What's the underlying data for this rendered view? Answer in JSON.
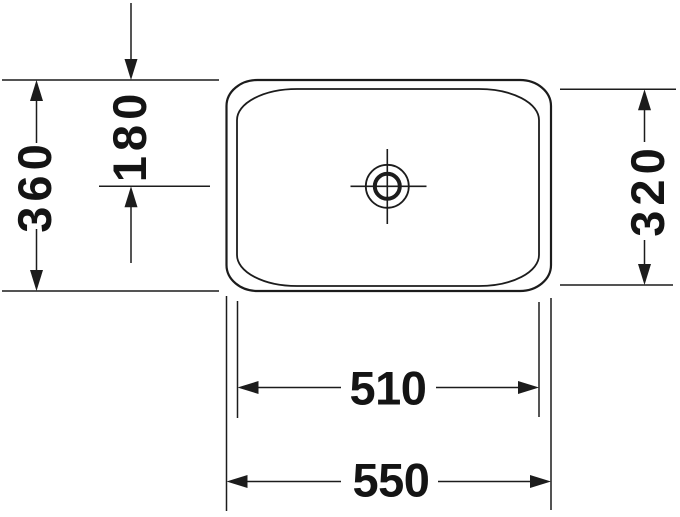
{
  "dimensions": {
    "overall_depth": "360",
    "drain_center_offset": "180",
    "inner_depth": "320",
    "inner_width": "510",
    "overall_width": "550"
  },
  "colors": {
    "line": "#1c1c1c",
    "text": "#141414",
    "background": "#ffffff"
  }
}
